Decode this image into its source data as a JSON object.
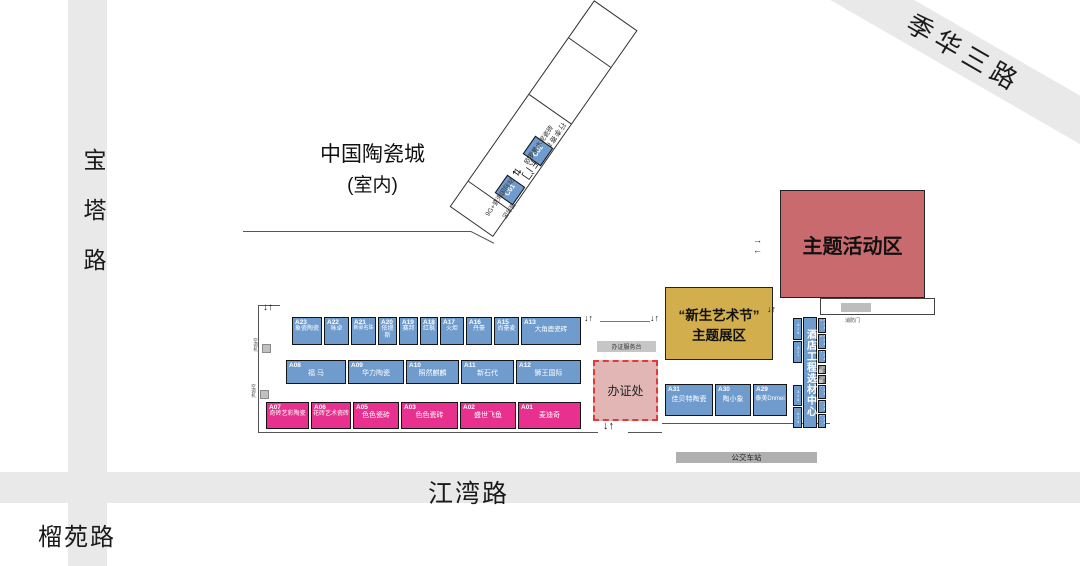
{
  "venue": {
    "name": "中国陶瓷城",
    "sub": "(室内)"
  },
  "roads": {
    "left": "宝塔路",
    "bottom": "江湾路",
    "bottom_left": "榴苑路",
    "top_right": "季华三路"
  },
  "gate": {
    "east_gate": "东门",
    "luggage": "行李寄存处",
    "service": "服务区",
    "c01": "C01",
    "c02": "C02",
    "c01_note": "9G+瓷海国际站",
    "c02_note": "欧罗曼水泥瓷砖"
  },
  "zones": {
    "activity": "主题活动区",
    "art_fest_line1": "“新生艺术节”",
    "art_fest_line2": "主题展区",
    "hotel_center": "酒店工程选材中心",
    "fire_door": "消防门",
    "badge_office": "办证处",
    "badge_desk": "办证服务台",
    "bus_station": "公交车站",
    "ac_unit": "空调机"
  },
  "booths": {
    "row1": [
      {
        "code": "A23",
        "name": "象瓷陶瓷"
      },
      {
        "code": "A22",
        "name": "咏卓"
      },
      {
        "code": "A21",
        "name": "新豪名珠"
      },
      {
        "code": "A20",
        "name": "依缦斯"
      },
      {
        "code": "A19",
        "name": "赛邦"
      },
      {
        "code": "A18",
        "name": "红枫"
      },
      {
        "code": "A17",
        "name": "火炬"
      },
      {
        "code": "A16",
        "name": "丹豪"
      },
      {
        "code": "A15",
        "name": "尚豪麦"
      },
      {
        "code": "A13",
        "name": "大角鹿瓷砖"
      }
    ],
    "row2": [
      {
        "code": "A08",
        "name": "福 马"
      },
      {
        "code": "A09",
        "name": "华力陶瓷"
      },
      {
        "code": "A10",
        "name": "照然麒麟"
      },
      {
        "code": "A11",
        "name": "新石代"
      },
      {
        "code": "A12",
        "name": "狮王国际"
      }
    ],
    "row3": [
      {
        "code": "A07",
        "name": "奇砖艺彩陶瓷"
      },
      {
        "code": "A06",
        "name": "花砖艺术瓷砖"
      },
      {
        "code": "A05",
        "name": "色色瓷砖"
      },
      {
        "code": "A03",
        "name": "色色瓷砖"
      },
      {
        "code": "A02",
        "name": "盛世飞鱼"
      },
      {
        "code": "A01",
        "name": "麦迪奇"
      }
    ],
    "right_row": [
      {
        "code": "A31",
        "name": "佳贝特陶瓷"
      },
      {
        "code": "A30",
        "name": "陶小象"
      },
      {
        "code": "A29",
        "name": "泰美Dnmei"
      }
    ],
    "side_left": [
      "A28",
      "A27",
      "A26",
      "A25"
    ],
    "side_right_top": [
      "A24-1",
      "A24-2",
      "A24-3"
    ],
    "side_right_bottom": [
      "A24-4",
      "A24-5",
      "A24-6"
    ]
  },
  "symbols": {
    "down_up": "↓↑",
    "into_right": "→",
    "into_left": "←",
    "gate_arrows": "⇄"
  }
}
